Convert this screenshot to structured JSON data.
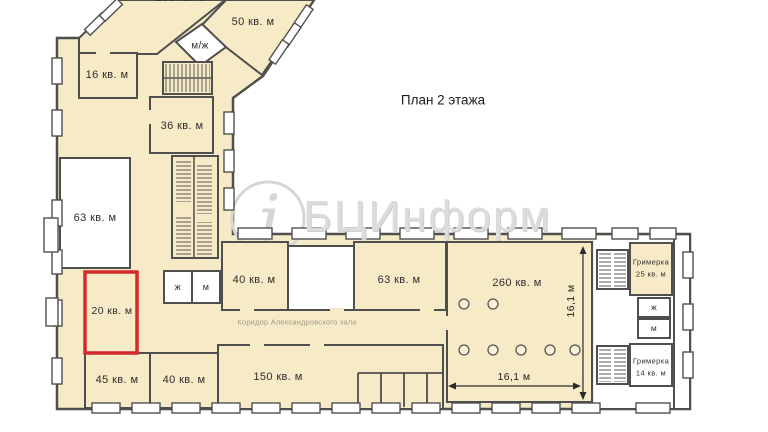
{
  "title": "План 2 этажа",
  "watermark": {
    "text": "БЦИнформ",
    "logo_glyph": "i"
  },
  "corridor": {
    "label": "Коридор Александровского зала"
  },
  "dimensions": {
    "horizontal": "16,1 м",
    "vertical": "16,1 м"
  },
  "highlight": {
    "room_id": "room-20",
    "color": "#d42a2a"
  },
  "colors": {
    "room_fill": "#f7eac6",
    "wall": "#4f4f4f",
    "highlight": "#d42a2a",
    "watermark": "#d6d6d6",
    "corridor_text": "#a39a8a"
  },
  "rooms": [
    {
      "id": "room-100",
      "label": "100 кв. м"
    },
    {
      "id": "room-50",
      "label": "50 кв. м"
    },
    {
      "id": "wc-shared",
      "label": "м/ж"
    },
    {
      "id": "room-16",
      "label": "16 кв. м"
    },
    {
      "id": "room-36",
      "label": "36 кв. м"
    },
    {
      "id": "room-63-west",
      "label": "63 кв. м"
    },
    {
      "id": "room-20",
      "label": "20 кв. м"
    },
    {
      "id": "room-45",
      "label": "45 кв. м"
    },
    {
      "id": "room-40-south",
      "label": "40 кв. м"
    },
    {
      "id": "wc-women-mid",
      "label": "ж"
    },
    {
      "id": "wc-men-mid",
      "label": "м"
    },
    {
      "id": "room-40-north",
      "label": "40 кв. м"
    },
    {
      "id": "room-63-north",
      "label": "63 кв. м"
    },
    {
      "id": "room-260",
      "label": "260 кв. м"
    },
    {
      "id": "room-150",
      "label": "150 кв. м"
    },
    {
      "id": "dressing-25",
      "name": "Гримерка",
      "area": "25 кв. м"
    },
    {
      "id": "wc-women-east",
      "label": "ж"
    },
    {
      "id": "wc-men-east",
      "label": "м"
    },
    {
      "id": "dressing-14",
      "name": "Гримерка",
      "area": "14 кв. м"
    }
  ]
}
